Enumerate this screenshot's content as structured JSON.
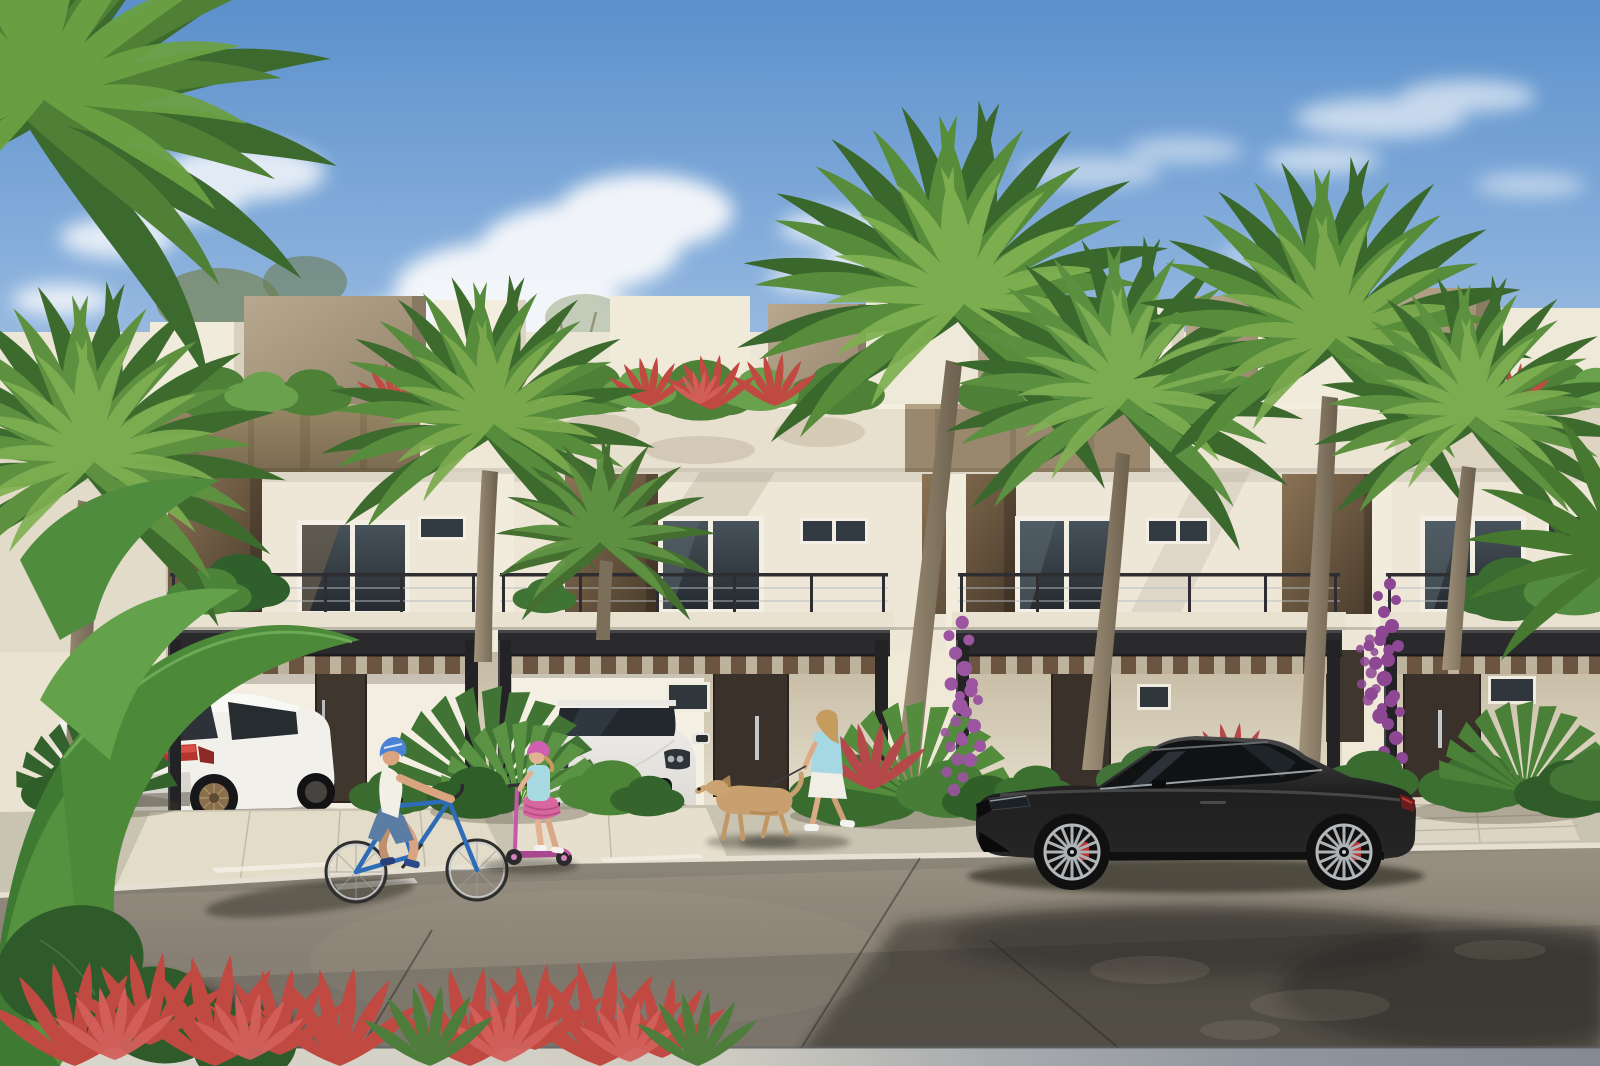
{
  "scene": {
    "title": "Sunny street-view architectural rendering of modern tropical townhomes",
    "type": "3D exterior rendering (no text or UI present in image)",
    "time_of_day": "bright daytime, blue sky with scattered clouds",
    "elements": {
      "buildings": "row of four two-story white townhomes with tan stone accent panels, rooftop terrace planters with shrubs and red accents, cable-rail balconies, dark steel pergola carports with wood slats, dark brown entry doors",
      "vehicles": [
        "white Mercedes SUV parked in left carport (rear view, red taillight band, bronze wheels)",
        "white Porsche Macan parked in center carport (front view, black grille)",
        "black Mercedes coupe parked on the street (side view, silver multi-spoke wheels, red brake calipers)"
      ],
      "people": [
        "man with blue helmet and white t-shirt riding a blue bicycle",
        "girl with pink helmet and light-blue top riding a pink kick scooter",
        "woman in light-blue top and white skirt walking a tan dog on a leash"
      ],
      "vegetation": [
        "tall coconut palm trees",
        "banana / bird-of-paradise foreground leaves",
        "red cordyline shrubs in foreground planter",
        "purple bougainvillea climbing pergola posts",
        "rooftop planter shrubs with red accents"
      ],
      "ground": "light concrete sidewalk and driveway aprons, dark asphalt street with long tree and building shadows, low light-grey wall ledge at extreme foreground"
    },
    "palette": {
      "sky_top": "#5b90cb",
      "sky_horizon": "#cddcee",
      "cloud_white": "#fdfdfd",
      "wall_white": "#f0e9da",
      "wall_shade": "#d9cfba",
      "stone_tan": "#93815f",
      "accent_brown": "#6d5a42",
      "pergola_steel": "#2b2a2c",
      "pergola_wood": "#7a5f45",
      "door_brown": "#3a322b",
      "window_glass": "#39424a",
      "sidewalk": "#d6d0bf",
      "asphalt": "#756f66",
      "palm_green": "#5d9140",
      "red_plant": "#c04a42",
      "bougainvillea": "#9c55a0",
      "suv_white": "#f2f0ea",
      "porsche_silver": "#eceae6",
      "coupe_black": "#1d1d1d",
      "taillight_red": "#c23630",
      "bike_blue": "#2f6cb8",
      "scooter_pink": "#c558a8",
      "helmet_blue": "#4a82d4",
      "helmet_pink": "#cf5fb0",
      "shirt_lightblue": "#a5d8e2",
      "dog_tan": "#c8a06f"
    }
  }
}
